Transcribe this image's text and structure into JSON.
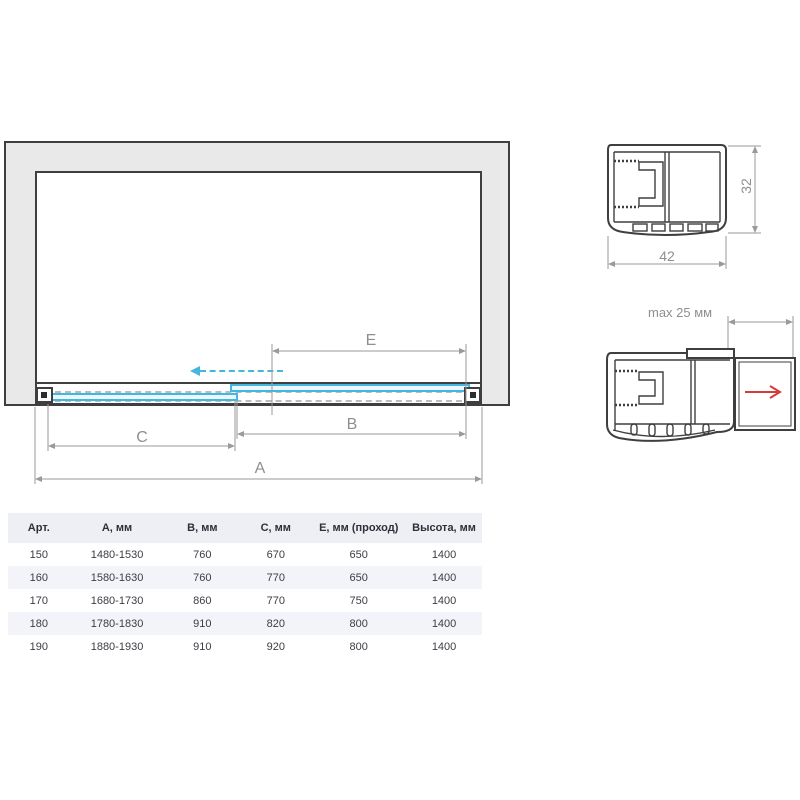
{
  "main_diagram": {
    "labels": {
      "A": "A",
      "B": "B",
      "C": "C",
      "E": "E"
    },
    "glass_color": "#45b6dd",
    "frame_color": "#3f3f3f",
    "wall_fill": "#e9e9e9",
    "dim_color": "#8f8f8f"
  },
  "profile_top": {
    "width_label": "42",
    "height_label": "32"
  },
  "profile_adjust": {
    "max_label": "max 25 мм",
    "arrow_color": "#d63b3b"
  },
  "table": {
    "headers": [
      "Арт.",
      "А, мм",
      "В, мм",
      "С, мм",
      "Е, мм (проход)",
      "Высота, мм"
    ],
    "rows": [
      [
        "150",
        "1480-1530",
        "760",
        "670",
        "650",
        "1400"
      ],
      [
        "160",
        "1580-1630",
        "760",
        "770",
        "650",
        "1400"
      ],
      [
        "170",
        "1680-1730",
        "860",
        "770",
        "750",
        "1400"
      ],
      [
        "180",
        "1780-1830",
        "910",
        "820",
        "800",
        "1400"
      ],
      [
        "190",
        "1880-1930",
        "910",
        "920",
        "800",
        "1400"
      ]
    ]
  }
}
